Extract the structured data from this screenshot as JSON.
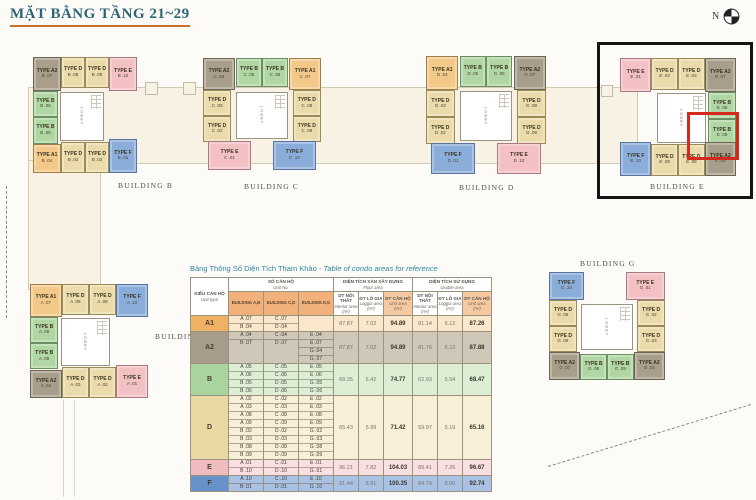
{
  "page": {
    "title": "MẶT BẰNG TẦNG 21~29",
    "north_label": "N"
  },
  "lobby_label": "LOBBY",
  "unit_types": {
    "A1": {
      "label": "TYPE A1",
      "fill": "#f3c98a",
      "border": "#a08049"
    },
    "A2": {
      "label": "TYPE A2",
      "fill": "#a89e8b",
      "border": "#6f6553"
    },
    "B": {
      "label": "TYPE B",
      "fill": "#afd6a3",
      "border": "#6b9162"
    },
    "D": {
      "label": "TYPE D",
      "fill": "#ebdbaa",
      "border": "#9d8a55"
    },
    "E": {
      "label": "TYPE E",
      "fill": "#f3c0c4",
      "border": "#ab7a82"
    },
    "F": {
      "label": "TYPE F",
      "fill": "#8badda",
      "border": "#5974a3"
    }
  },
  "buildings": [
    {
      "id": "b",
      "name": "BUILDING B",
      "layout": "sideL",
      "x": 33,
      "y": 57,
      "w": 104,
      "h": 116,
      "label_x": 118,
      "label_y": 181,
      "units": [
        {
          "slot": "tl",
          "type": "A2",
          "no": "B .07"
        },
        {
          "slot": "tm1",
          "type": "D",
          "no": "B .08"
        },
        {
          "slot": "tm2",
          "type": "D",
          "no": "B .09"
        },
        {
          "slot": "tr",
          "type": "E",
          "no": "B .10"
        },
        {
          "slot": "s1",
          "type": "B",
          "no": "B .06"
        },
        {
          "slot": "s2",
          "type": "B",
          "no": "B .05"
        },
        {
          "slot": "bl",
          "type": "A1",
          "no": "B .04"
        },
        {
          "slot": "bm1",
          "type": "D",
          "no": "B .03"
        },
        {
          "slot": "bm2",
          "type": "D",
          "no": "B .02"
        },
        {
          "slot": "br",
          "type": "F",
          "no": "B .01"
        }
      ]
    },
    {
      "id": "c",
      "name": "BUILDING C",
      "layout": "topT",
      "x": 203,
      "y": 58,
      "w": 118,
      "h": 112,
      "label_x": 244,
      "label_y": 182,
      "units": [
        {
          "slot": "tl",
          "type": "A2",
          "no": "C .04"
        },
        {
          "slot": "tm1",
          "type": "B",
          "no": "C .05"
        },
        {
          "slot": "tm2",
          "type": "B",
          "no": "C .06"
        },
        {
          "slot": "tr",
          "type": "A1",
          "no": "C .07"
        },
        {
          "slot": "s1",
          "type": "D",
          "no": "C .03"
        },
        {
          "slot": "s2",
          "type": "D",
          "no": "C .02"
        },
        {
          "slot": "s3",
          "type": "D",
          "no": "C .08"
        },
        {
          "slot": "s4",
          "type": "D",
          "no": "C .09"
        },
        {
          "slot": "bl",
          "type": "E",
          "no": "C .01"
        },
        {
          "slot": "br",
          "type": "F",
          "no": "C .10"
        }
      ]
    },
    {
      "id": "d",
      "name": "BUILDING D",
      "layout": "topT",
      "x": 426,
      "y": 56,
      "w": 120,
      "h": 118,
      "label_x": 459,
      "label_y": 183,
      "units": [
        {
          "slot": "tl",
          "type": "A1",
          "no": "D .04"
        },
        {
          "slot": "tm1",
          "type": "B",
          "no": "D .05"
        },
        {
          "slot": "tm2",
          "type": "B",
          "no": "D .06"
        },
        {
          "slot": "tr",
          "type": "A2",
          "no": "D .07"
        },
        {
          "slot": "s1",
          "type": "D",
          "no": "D .03"
        },
        {
          "slot": "s2",
          "type": "D",
          "no": "D .02"
        },
        {
          "slot": "s3",
          "type": "D",
          "no": "D .08"
        },
        {
          "slot": "s4",
          "type": "D",
          "no": "D .09"
        },
        {
          "slot": "bl",
          "type": "F",
          "no": "D .01"
        },
        {
          "slot": "br",
          "type": "E",
          "no": "D .10"
        }
      ]
    },
    {
      "id": "e",
      "name": "BUILDING E",
      "layout": "sideR",
      "x": 620,
      "y": 58,
      "w": 116,
      "h": 118,
      "label_x": 650,
      "label_y": 182,
      "units": [
        {
          "slot": "tl",
          "type": "E",
          "no": "E .01"
        },
        {
          "slot": "tm1",
          "type": "D",
          "no": "E .02"
        },
        {
          "slot": "tm2",
          "type": "D",
          "no": "E .03"
        },
        {
          "slot": "tr",
          "type": "A2",
          "no": "E .07"
        },
        {
          "slot": "s1",
          "type": "B",
          "no": "E .06"
        },
        {
          "slot": "s2",
          "type": "B",
          "no": "E .05"
        },
        {
          "slot": "bl",
          "type": "F",
          "no": "E .10"
        },
        {
          "slot": "bm1",
          "type": "D",
          "no": "E .09"
        },
        {
          "slot": "bm2",
          "type": "D",
          "no": "E .08"
        },
        {
          "slot": "br",
          "type": "A2",
          "no": "E .04"
        }
      ]
    },
    {
      "id": "a",
      "name": "BUILDING A",
      "layout": "sideL",
      "x": 30,
      "y": 284,
      "w": 118,
      "h": 114,
      "label_x": 155,
      "label_y": 332,
      "units": [
        {
          "slot": "tl",
          "type": "A1",
          "no": "A .07"
        },
        {
          "slot": "tm1",
          "type": "D",
          "no": "A .08"
        },
        {
          "slot": "tm2",
          "type": "D",
          "no": "A .09"
        },
        {
          "slot": "tr",
          "type": "F",
          "no": "A .10"
        },
        {
          "slot": "s1",
          "type": "B",
          "no": "A .06"
        },
        {
          "slot": "s2",
          "type": "B",
          "no": "A .05"
        },
        {
          "slot": "bl",
          "type": "A2",
          "no": "A .04"
        },
        {
          "slot": "bm1",
          "type": "D",
          "no": "A .03"
        },
        {
          "slot": "bm2",
          "type": "D",
          "no": "A .02"
        },
        {
          "slot": "br",
          "type": "E",
          "no": "A .01"
        }
      ]
    },
    {
      "id": "g",
      "name": "BUILDING G",
      "layout": "topB",
      "x": 549,
      "y": 272,
      "w": 116,
      "h": 108,
      "label_x": 580,
      "label_y": 259,
      "units": [
        {
          "slot": "tl",
          "type": "F",
          "no": "G .10"
        },
        {
          "slot": "tr",
          "type": "E",
          "no": "G .01"
        },
        {
          "slot": "s1",
          "type": "D",
          "no": "G .09"
        },
        {
          "slot": "s2",
          "type": "D",
          "no": "G .08"
        },
        {
          "slot": "s3",
          "type": "D",
          "no": "G .02"
        },
        {
          "slot": "s4",
          "type": "D",
          "no": "G .03"
        },
        {
          "slot": "bl",
          "type": "A2",
          "no": "G .07"
        },
        {
          "slot": "bm1",
          "type": "B",
          "no": "G .06"
        },
        {
          "slot": "bm2",
          "type": "B",
          "no": "G .05"
        },
        {
          "slot": "br",
          "type": "A2",
          "no": "G .04"
        }
      ]
    }
  ],
  "table_row_colors": {
    "A1": {
      "label": "#efb164",
      "cells": "#fbe7cc"
    },
    "A2": {
      "label": "#a79c89",
      "cells": "#cfc7b8"
    },
    "B": {
      "label": "#a9d49d",
      "cells": "#dcefd5"
    },
    "D": {
      "label": "#e9d8a2",
      "cells": "#f7efd7"
    },
    "E": {
      "label": "#f1bcbf",
      "cells": "#f9dfe1"
    },
    "F": {
      "label": "#6691c9",
      "cells": "#a9c1e3"
    }
  },
  "table": {
    "title": {
      "vi": "Bảng Thông Số Diện Tích Tham Khảo -",
      "en": "Table of condo areas for reference"
    },
    "header": {
      "unit_type": {
        "vi": "KIỂU CĂN HỘ",
        "en": "Unit type"
      },
      "unit_no": {
        "vi": "SỐ CĂN HỘ",
        "en": "Unit No."
      },
      "buildings": [
        "BUILDING A,B",
        "BUILDING C,D",
        "BUILDING E,G"
      ],
      "groups": [
        {
          "vi": "DIỆN TÍCH SÀN XÂY DỰNG",
          "en": "Floor area"
        },
        {
          "vi": "DIỆN TÍCH SỬ DỤNG",
          "en": "Usable area"
        }
      ],
      "measures": [
        {
          "vi": "DT NỘI THẤT",
          "en": "Interior area",
          "unit": "(m²)",
          "hl": false
        },
        {
          "vi": "DT LÔ GIA",
          "en": "Loggia area",
          "unit": "(m²)",
          "hl": false
        },
        {
          "vi": "DT CĂN HỘ",
          "en": "Unit area",
          "unit": "(m²)",
          "hl": true
        },
        {
          "vi": "DT NỘI THẤT",
          "en": "Interior area",
          "unit": "(m²)",
          "hl": false
        },
        {
          "vi": "DT LÔ GIA",
          "en": "Loggia area",
          "unit": "(m²)",
          "hl": false
        },
        {
          "vi": "DT CĂN HỘ",
          "en": "Unit area",
          "unit": "(m²)",
          "hl": true
        }
      ]
    },
    "rows": [
      {
        "type": "A1",
        "units": [
          [
            "A .07",
            "B .04"
          ],
          [
            "C .07",
            "D .04"
          ],
          []
        ],
        "values": [
          "87.87",
          "7.02",
          "94.89",
          "81.14",
          "6.12",
          "87.26"
        ]
      },
      {
        "type": "A2",
        "units": [
          [
            "A .04",
            "B .07"
          ],
          [
            "C .04",
            "D .07"
          ],
          [
            "E .04",
            "E .07",
            "G .04",
            "G .07"
          ]
        ],
        "values": [
          "87.87",
          "7.02",
          "94.89",
          "81.76",
          "6.12",
          "87.88"
        ]
      },
      {
        "type": "B",
        "units": [
          [
            "A .05",
            "A .06",
            "B .05",
            "B .06"
          ],
          [
            "C .05",
            "C .06",
            "D .05",
            "D .06"
          ],
          [
            "E .05",
            "E .06",
            "G .05",
            "G .06"
          ]
        ],
        "values": [
          "68.35",
          "6.42",
          "74.77",
          "62.93",
          "5.54",
          "68.47"
        ]
      },
      {
        "type": "D",
        "units": [
          [
            "A .02",
            "A .03",
            "A .08",
            "A .09",
            "B .02",
            "B .03",
            "B .08",
            "B .09"
          ],
          [
            "C .02",
            "C .03",
            "C .08",
            "C .09",
            "D .02",
            "D .03",
            "D .08",
            "D .09"
          ],
          [
            "E .02",
            "E .03",
            "E .08",
            "E .09",
            "G .02",
            "G .03",
            "G .08",
            "G .09"
          ]
        ],
        "values": [
          "65.43",
          "5.99",
          "71.42",
          "59.97",
          "5.19",
          "65.16"
        ]
      },
      {
        "type": "E",
        "units": [
          [
            "A .01",
            "B .10"
          ],
          [
            "C .01",
            "D .10"
          ],
          [
            "E .01",
            "G .01"
          ]
        ],
        "values": [
          "96.21",
          "7.82",
          "104.03",
          "89.41",
          "7.26",
          "96.67"
        ]
      },
      {
        "type": "F",
        "units": [
          [
            "A .10",
            "B .01"
          ],
          [
            "C .10",
            "D .01"
          ],
          [
            "E .10",
            "G .10"
          ]
        ],
        "values": [
          "91.44",
          "8.91",
          "100.35",
          "84.74",
          "8.00",
          "92.74"
        ]
      }
    ]
  }
}
